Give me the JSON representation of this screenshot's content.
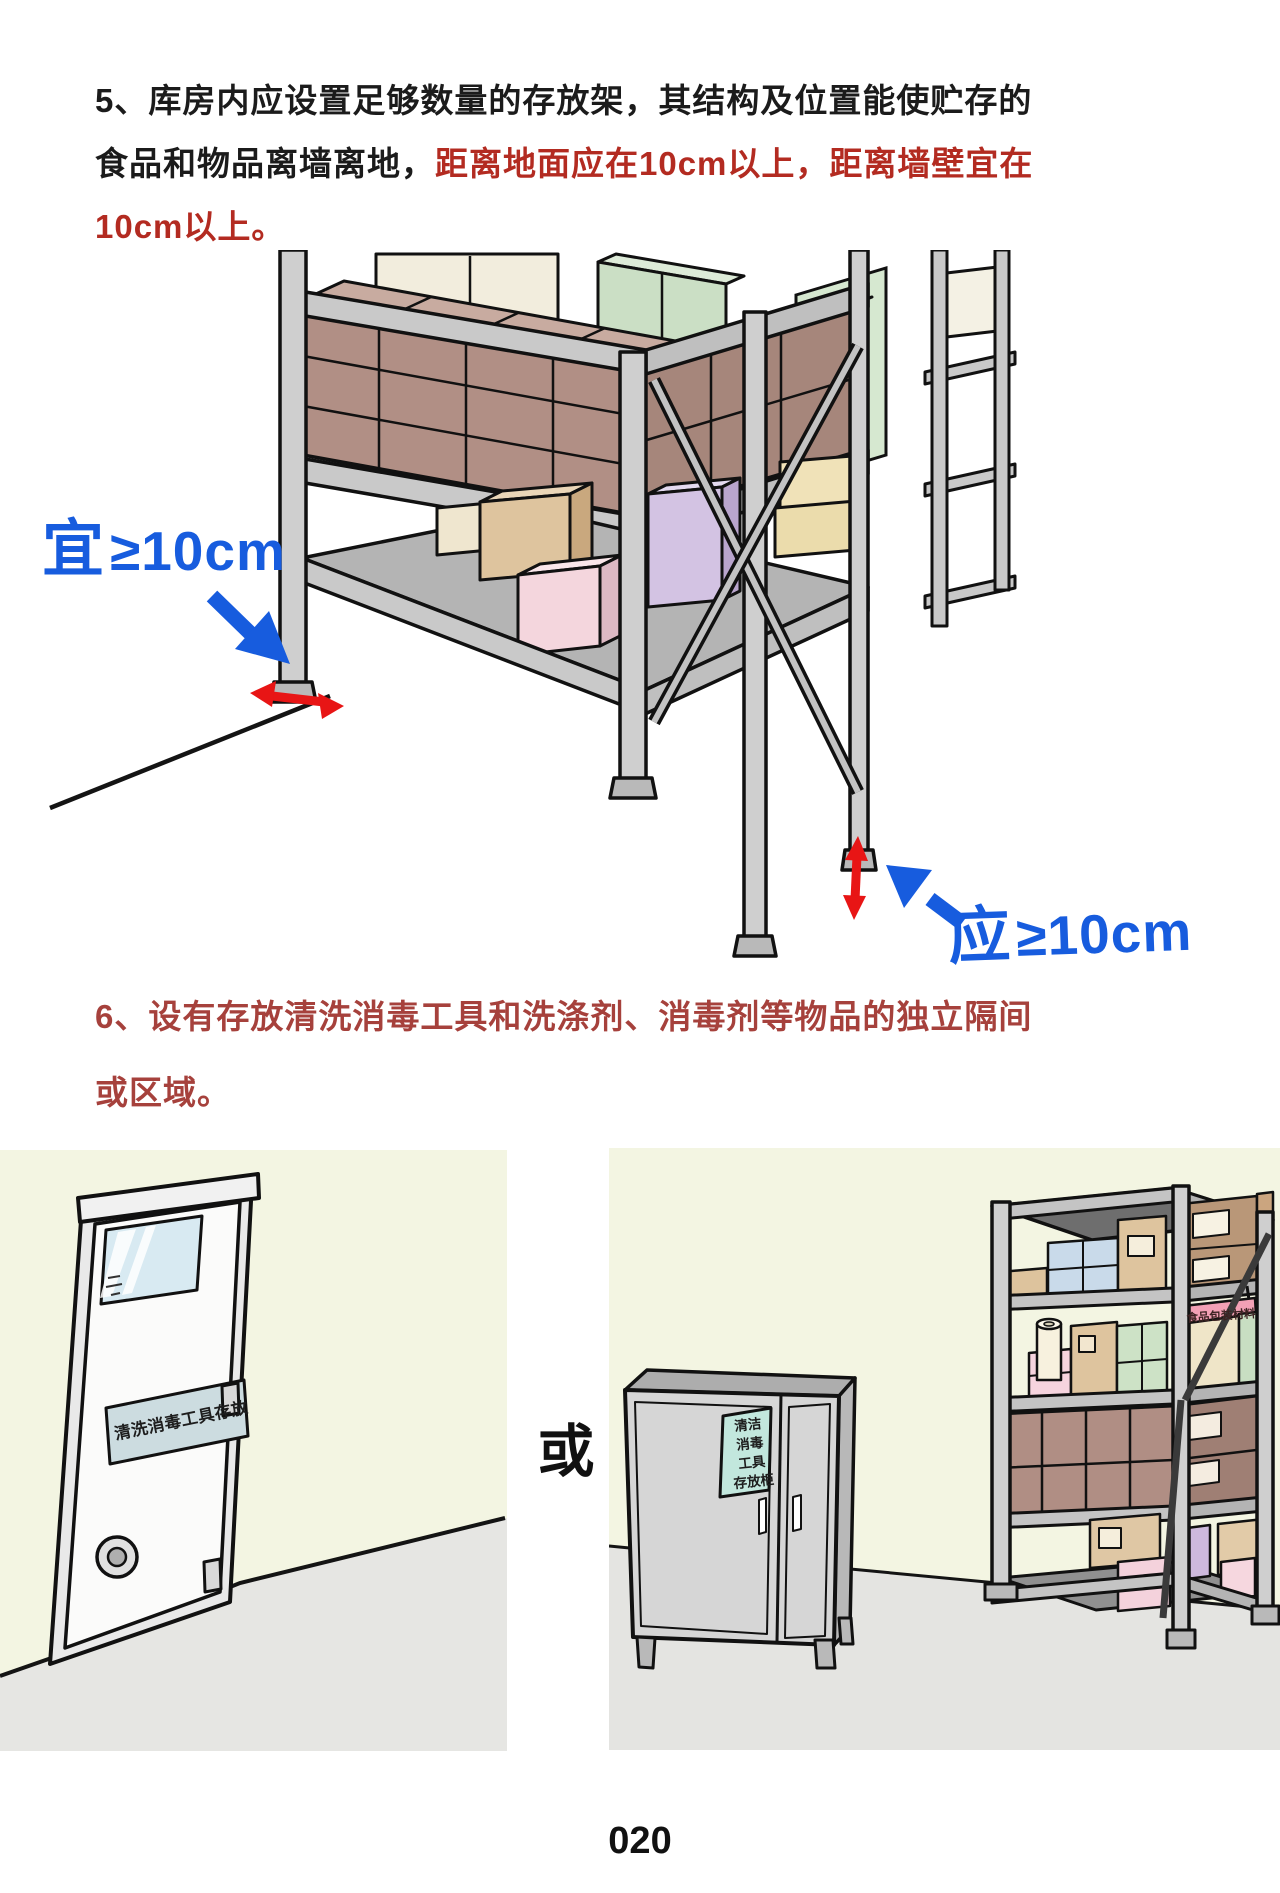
{
  "page": {
    "number": "020",
    "background": "#ffffff"
  },
  "colors": {
    "heading_red": "#b32b21",
    "section6_red": "#a6413c",
    "annotation_blue": "#175cde",
    "arrow_red": "#e81515"
  },
  "section5": {
    "line1": "5、库房内应设置足够数量的存放架，其结构及位置能使贮存的",
    "line2_black": "食品和物品离墙离地，",
    "line2_red": "距离地面应在10cm以上，距离墙壁宜在",
    "line3_red": "10cm以上。"
  },
  "rack_figure": {
    "wall_label_cjk": "宜",
    "wall_label_value": "≥10cm",
    "floor_label_cjk": "应",
    "floor_label_value": "≥10cm"
  },
  "section6": {
    "line1": "6、设有存放清洗消毒工具和洗涤剂、消毒剂等物品的独立隔间",
    "line2": "或区域。"
  },
  "storage_figure": {
    "or_label": "或",
    "door_sign": "清洗消毒工具存放",
    "cabinet_sign_lines": [
      "清洁",
      "消毒",
      "工具",
      "存放柜"
    ],
    "rack_sign": "食品包装材料"
  }
}
